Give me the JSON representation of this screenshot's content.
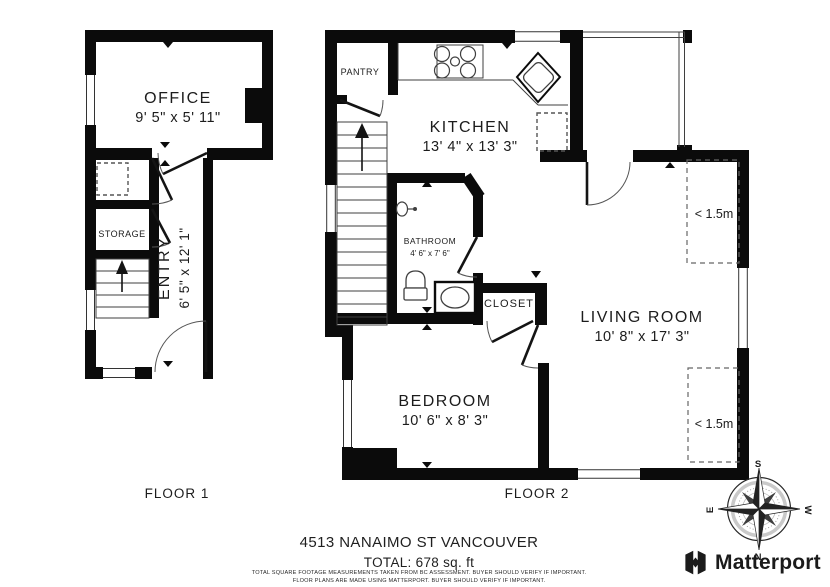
{
  "floor1": {
    "label": "FLOOR 1",
    "rooms": {
      "office": {
        "name": "OFFICE",
        "dims": "9' 5\" x 5' 11\""
      },
      "storage": {
        "name": "STORAGE"
      },
      "entry": {
        "name": "ENTRY",
        "dims": "6' 5\" x 12' 1\""
      }
    }
  },
  "floor2": {
    "label": "FLOOR 2",
    "rooms": {
      "pantry": {
        "name": "PANTRY"
      },
      "kitchen": {
        "name": "KITCHEN",
        "dims": "13' 4\" x 13' 3\""
      },
      "bathroom": {
        "name": "BATHROOM",
        "dims": "4' 6\" x 7' 6\""
      },
      "closet": {
        "name": "CLOSET"
      },
      "living_room": {
        "name": "LIVING ROOM",
        "dims": "10' 8\" x 17' 3\""
      },
      "bedroom": {
        "name": "BEDROOM",
        "dims": "10' 6\" x 8' 3\""
      }
    },
    "annotations": {
      "ceiling_height_1": "< 1.5m",
      "ceiling_height_2": "< 1.5m"
    }
  },
  "footer": {
    "address": "4513 NANAIMO ST VANCOUVER",
    "total": "TOTAL: 678 sq. ft",
    "disclaimer_line1": "TOTAL SQUARE FOOTAGE MEASUREMENTS TAKEN FROM BC ASSESSMENT. BUYER SHOULD VERIFY IF IMPORTANT.",
    "disclaimer_line2": "FLOOR PLANS ARE MADE USING MATTERPORT. BUYER SHOULD VERIFY IF IMPORTANT."
  },
  "compass": {
    "n": "N",
    "s": "S",
    "e": "E",
    "w": "W"
  },
  "branding": {
    "logo_text": "Matterport"
  },
  "colors": {
    "wall": "#0b0b0b",
    "background": "#ffffff",
    "text": "#1c1c1c"
  }
}
